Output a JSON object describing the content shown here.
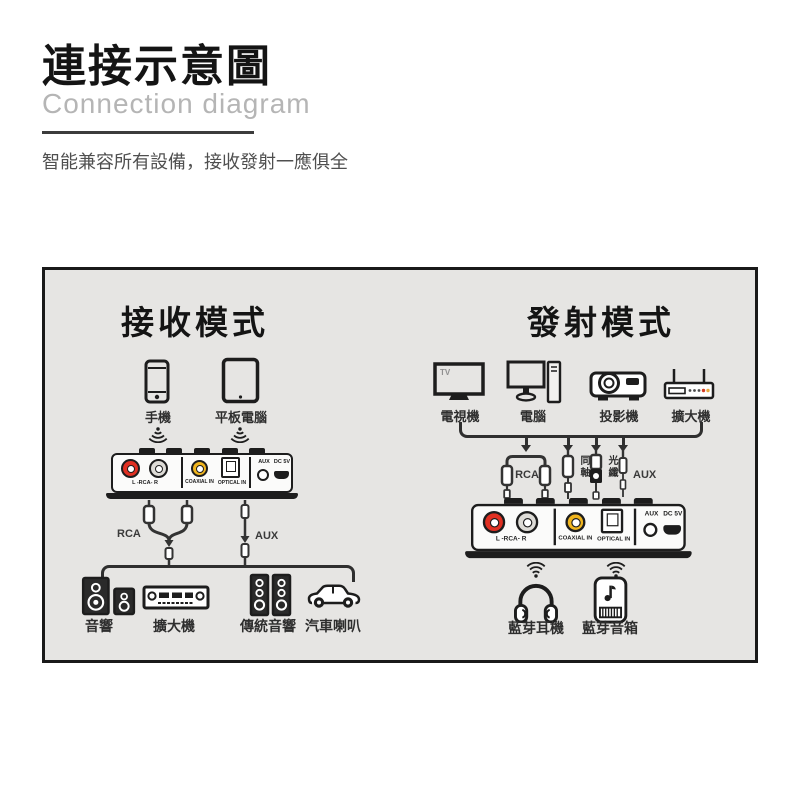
{
  "header": {
    "title": "連接示意圖",
    "subtitle": "Connection diagram",
    "tagline": "智能兼容所有設備，接收發射一應俱全"
  },
  "receive": {
    "title": "接收模式",
    "phone_label": "手機",
    "tablet_label": "平板電腦",
    "rca_cable_label": "RCA",
    "aux_cable_label": "AUX",
    "outputs": [
      {
        "label": "音響"
      },
      {
        "label": "擴大機"
      },
      {
        "label": "傳統音響"
      },
      {
        "label": "汽車喇叭"
      }
    ]
  },
  "transmit": {
    "title": "發射模式",
    "tv_label": "電視機",
    "tv_screen_badge": "TV",
    "computer_label": "電腦",
    "projector_label": "投影機",
    "amplifier_label": "擴大機",
    "rca_cable_label": "RCA",
    "coaxial_cable_label": "同軸",
    "optical_cable_label": "光纖",
    "aux_cable_label": "AUX",
    "headphones_label": "藍芽耳機",
    "speaker_label": "藍芽音箱"
  },
  "device_ports": {
    "rca": "L -RCA- R",
    "coaxial": "COAXIAL IN",
    "optical": "OPTICAL IN",
    "aux": "AUX",
    "power": "DC 5V"
  },
  "icons": {
    "phone": "smartphone-icon",
    "tablet": "tablet-icon",
    "wireless_down": "wireless-signal-down-icon",
    "wifi": "wifi-signal-icon",
    "tv": "tv-icon",
    "computer": "desktop-computer-icon",
    "projector": "projector-icon",
    "wifi_amplifier": "antenna-amplifier-icon",
    "bookshelf_speakers": "bookshelf-speakers-icon",
    "stereo_receiver": "stereo-receiver-icon",
    "tower_speakers": "tower-speakers-icon",
    "car": "car-icon",
    "headphones": "headphones-icon",
    "bluetooth_speaker": "bluetooth-speaker-icon"
  },
  "colors": {
    "box_background": "#e6e5e3",
    "outline": "#1d1d1d",
    "rca_red": "#e03022",
    "coax_yellow": "#f0b51e",
    "subtitle_gray": "#b5b5b5"
  }
}
